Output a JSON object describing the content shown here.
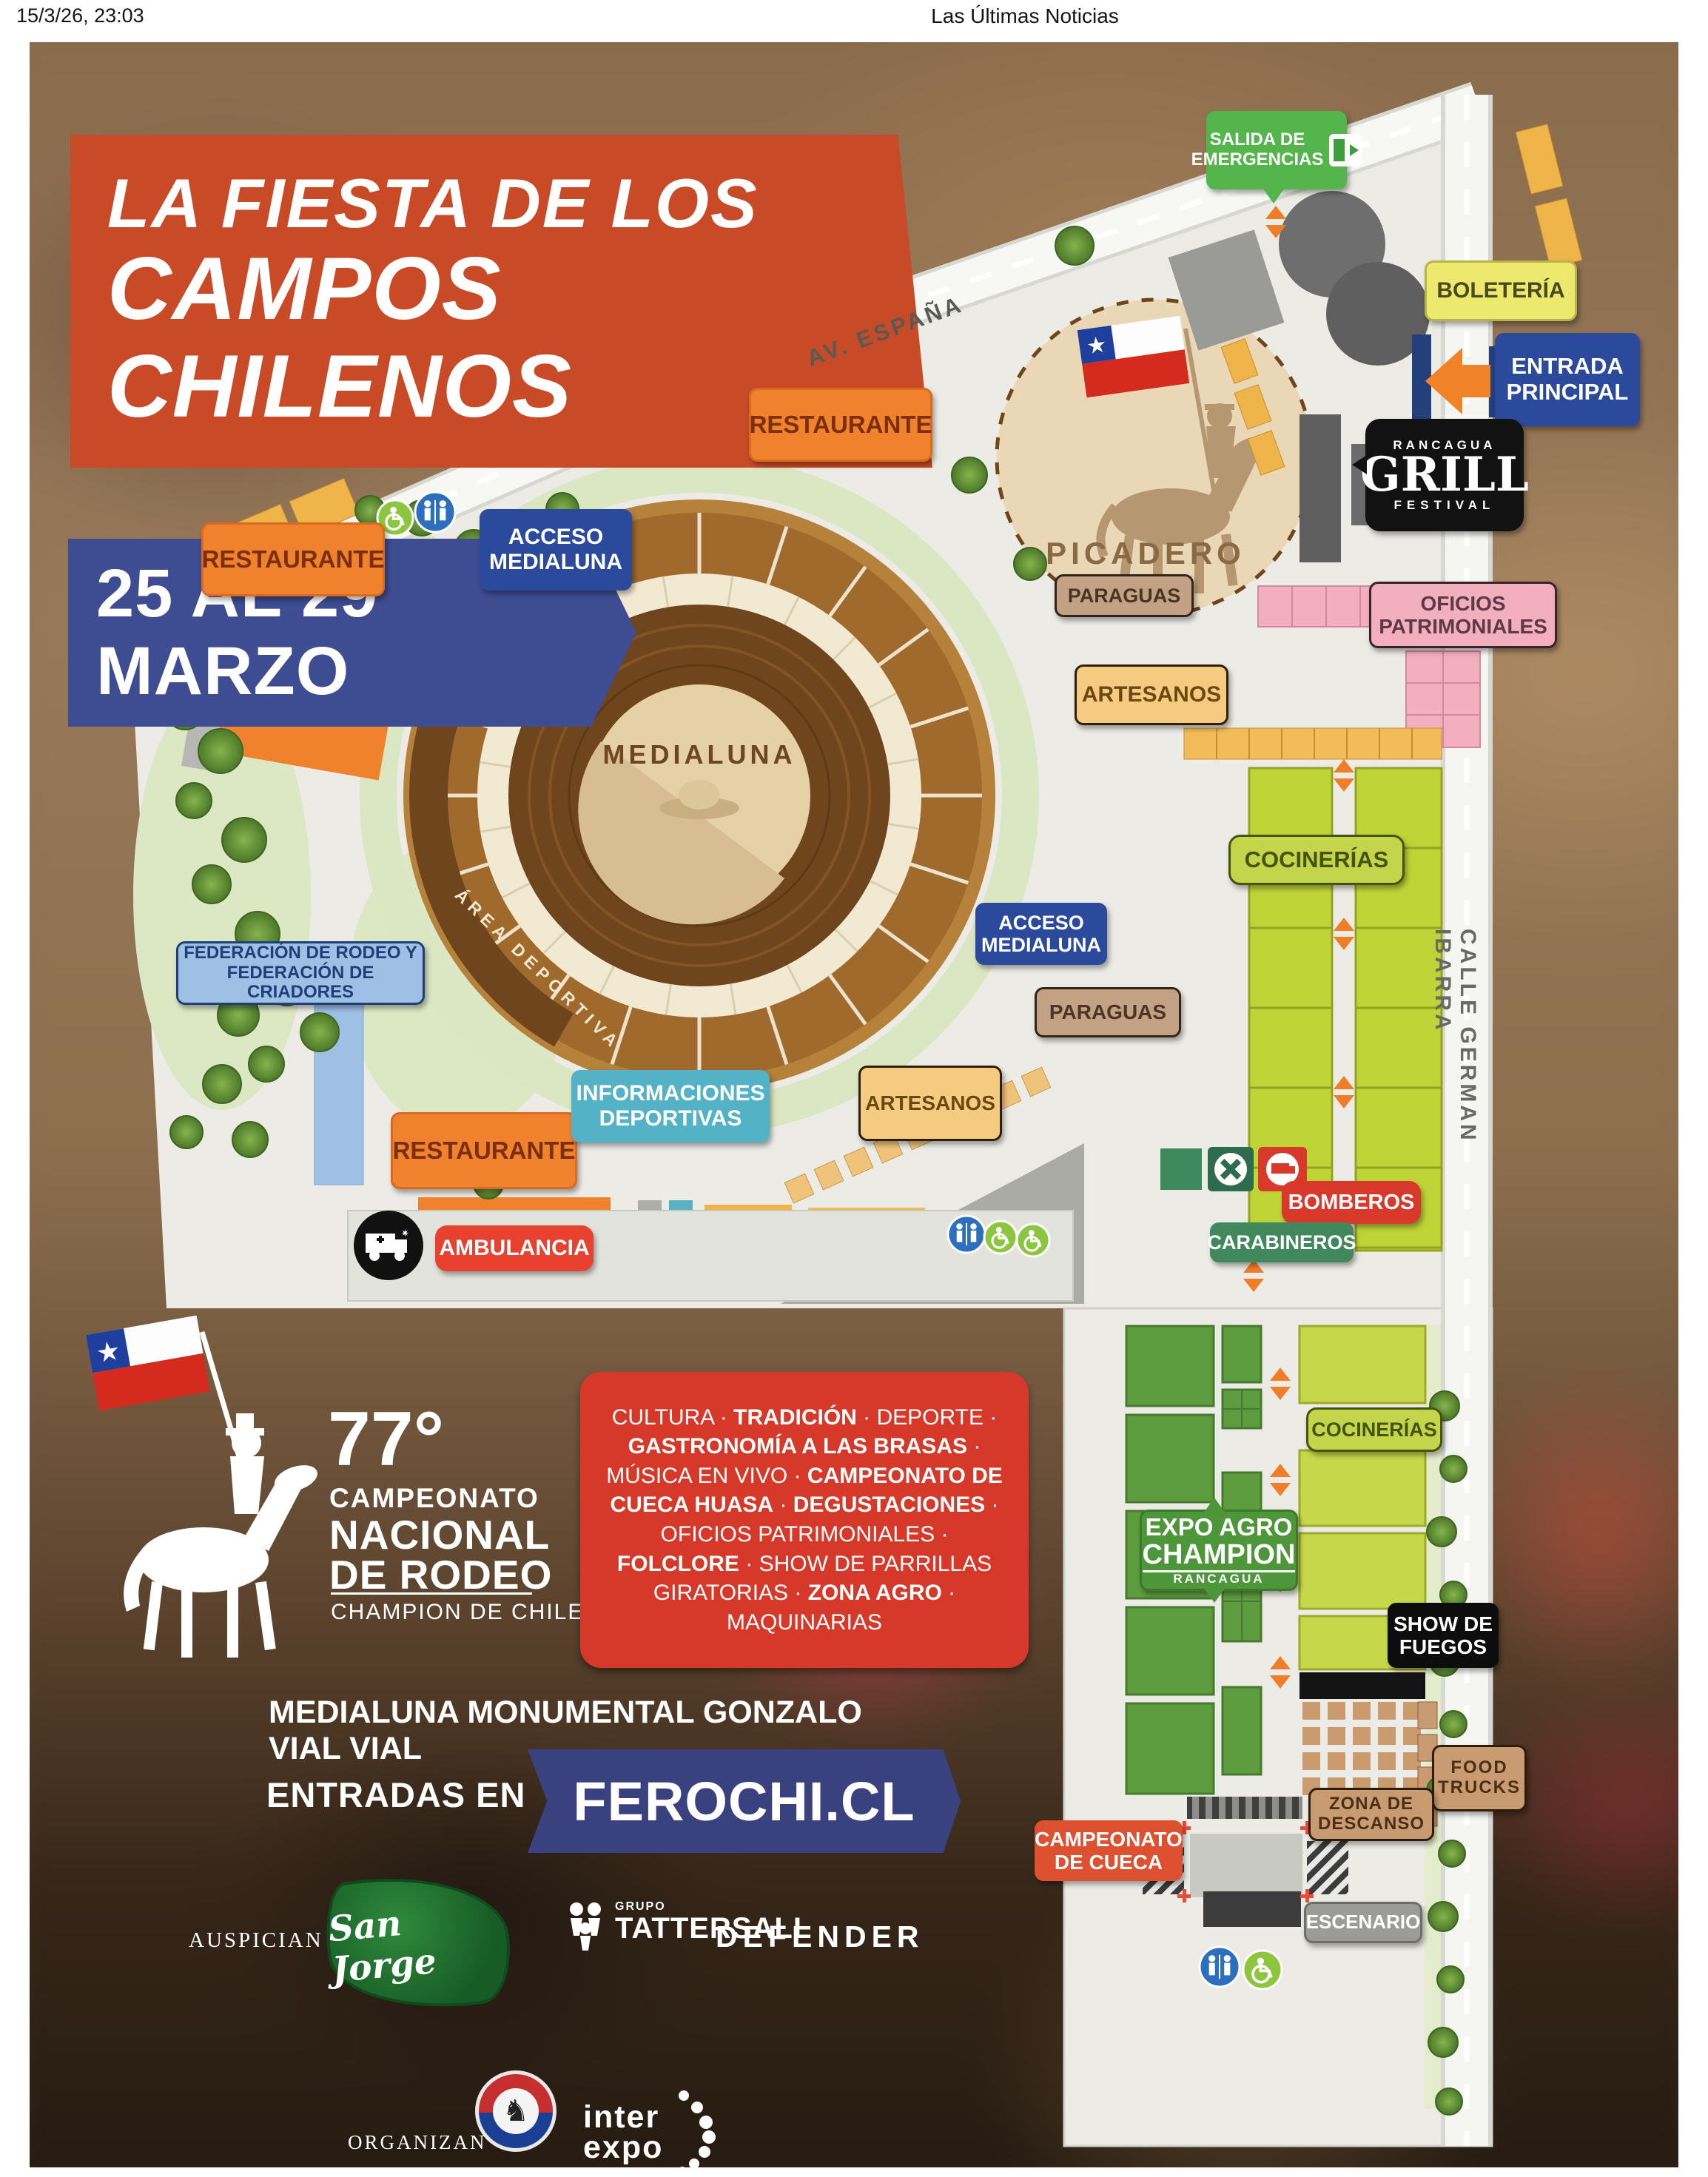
{
  "page": {
    "timestamp": "15/3/26, 23:03",
    "site_title": "Las Últimas Noticias"
  },
  "banner": {
    "title_line1": "LA FIESTA DE LOS",
    "title_line2": "CAMPOS CHILENOS",
    "dates": "25 AL 29 MARZO"
  },
  "roads": {
    "av_espana": "AV. ESPAÑA",
    "calle_german_ibarra": "CALLE GERMAN IBARRA"
  },
  "map": {
    "salida_emergencias": "SALIDA DE\nEMERGENCIAS",
    "boleteria": "BOLETERÍA",
    "entrada_principal": "ENTRADA\nPRINCIPAL",
    "restaurante_top": "RESTAURANTE",
    "restaurante_left": "RESTAURANTE",
    "restaurante_bottom": "RESTAURANTE",
    "picadero": "PICADERO",
    "grill": {
      "top": "RANCAGUA",
      "main": "GRILL",
      "bottom": "FESTIVAL"
    },
    "oficios_patrimoniales": "OFICIOS\nPATRIMONIALES",
    "paraguas_top": "PARAGUAS",
    "paraguas_bottom": "PARAGUAS",
    "artesanos_top": "ARTESANOS",
    "artesanos_bottom": "ARTESANOS",
    "acceso_medialuna_top": "ACCESO\nMEDIALUNA",
    "acceso_medialuna_bottom": "ACCESO\nMEDIALUNA",
    "medialuna": "MEDIALUNA",
    "area_deportiva": "ÁREA DEPORTIVA",
    "cocinerias_top": "COCINERÍAS",
    "cocinerias_bottom": "COCINERÍAS",
    "federacion": "FEDERACIÓN DE RODEO Y\nFEDERACIÓN DE CRIADORES",
    "informaciones_deportivas": "INFORMACIONES\nDEPORTIVAS",
    "ambulancia": "AMBULANCIA",
    "bomberos": "BOMBEROS",
    "carabineros": "CARABINEROS",
    "expo_agro": {
      "l1": "EXPO AGRO",
      "l2": "CHAMPION",
      "l3": "RANCAGUA"
    },
    "show_de_fuegos": "SHOW DE\nFUEGOS",
    "food_trucks": "FOOD\nTRUCKS",
    "zona_de_descanso": "ZONA DE\nDESCANSO",
    "campeonato_de_cueca": "CAMPEONATO\nDE CUECA",
    "escenario": "ESCENARIO"
  },
  "event": {
    "number": "77°",
    "line1": "CAMPEONATO",
    "line2": "NACIONAL",
    "line3": "DE RODEO",
    "subtitle": "CHAMPION DE CHILE"
  },
  "activities": [
    {
      "t": "CULTURA  · ",
      "b": false
    },
    {
      "t": "TRADICIÓN",
      "b": true
    },
    {
      "t": " · DEPORTE · ",
      "b": false
    },
    {
      "t": "GASTRONOMÍA A LAS BRASAS",
      "b": true
    },
    {
      "t": " · MÚSICA EN VIVO · ",
      "b": false
    },
    {
      "t": "CAMPEONATO DE CUECA HUASA",
      "b": true
    },
    {
      "t": " · ",
      "b": false
    },
    {
      "t": "DEGUSTACIONES",
      "b": true
    },
    {
      "t": " · OFICIOS PATRIMONIALES · ",
      "b": false
    },
    {
      "t": "FOLCLORE",
      "b": true
    },
    {
      "t": " · SHOW DE PARRILLAS GIRATORIAS · ",
      "b": false
    },
    {
      "t": "ZONA AGRO",
      "b": true
    },
    {
      "t": " · MAQUINARIAS",
      "b": false
    }
  ],
  "venue": "MEDIALUNA MONUMENTAL GONZALO VIAL VIAL",
  "tickets": {
    "label": "ENTRADAS EN",
    "site": "FEROCHI.CL"
  },
  "sponsors": {
    "auspician_label": "AUSPICIAN",
    "san_jorge": "San Jorge",
    "grupo": "GRUPO",
    "tattersall": "TATTERSALL",
    "defender": "DEFENDER",
    "organizan_label": "ORGANIZAN",
    "inter": "inter",
    "expo": "expo"
  },
  "colors": {
    "ribbon_orange": "#C84A26",
    "ribbon_blue": "#3E4C92",
    "badge_orange": "#F0812D",
    "badge_blue": "#2C4A9C",
    "badge_green": "#53B54B",
    "badge_yellow": "#EDE96E",
    "badge_pink": "#F3AEBF",
    "badge_lime": "#C3D64B",
    "badge_red": "#E8412F",
    "badge_tan": "#C89B72",
    "ferochi_navy": "#39427E",
    "map_ground": "#ECEBE6"
  }
}
